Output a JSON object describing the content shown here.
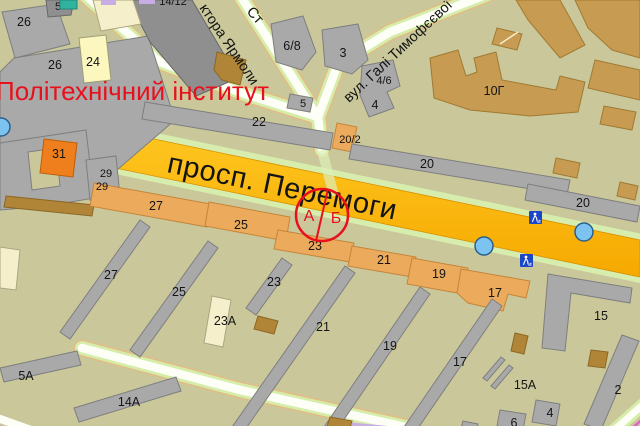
{
  "poi": {
    "institute": "Політехнічний інститут"
  },
  "streets": {
    "avenue": "просп. Перемоги",
    "tymofieievoi": "вул. Галі Тимофєєвої",
    "yarmoly_partial": "ктора Ярмоли",
    "st_partial": "Ст"
  },
  "marker": {
    "a": "А",
    "b": "Б"
  },
  "labels": [
    {
      "t": "26"
    },
    {
      "t": "5"
    },
    {
      "t": "26"
    },
    {
      "t": "24"
    },
    {
      "t": "14/12"
    },
    {
      "t": "6/8"
    },
    {
      "t": "3"
    },
    {
      "t": "4/6"
    },
    {
      "t": "4"
    },
    {
      "t": "5"
    },
    {
      "t": "22"
    },
    {
      "t": "20/2"
    },
    {
      "t": "20"
    },
    {
      "t": "20"
    },
    {
      "t": "10Г"
    },
    {
      "t": "31"
    },
    {
      "t": "29"
    },
    {
      "t": "29"
    },
    {
      "t": "27"
    },
    {
      "t": "25"
    },
    {
      "t": "23"
    },
    {
      "t": "21"
    },
    {
      "t": "19"
    },
    {
      "t": "17"
    },
    {
      "t": "27"
    },
    {
      "t": "25"
    },
    {
      "t": "23"
    },
    {
      "t": "23А"
    },
    {
      "t": "21"
    },
    {
      "t": "19"
    },
    {
      "t": "17"
    },
    {
      "t": "15"
    },
    {
      "t": "15А"
    },
    {
      "t": "2"
    },
    {
      "t": "4"
    },
    {
      "t": "6"
    },
    {
      "t": "5А"
    },
    {
      "t": "14А"
    }
  ],
  "colors": {
    "background": "#CAC89B",
    "avenue_yellow": "#FFC208",
    "minor_road": "#FDFEF5",
    "road_halo_green": "#D5EDA9",
    "poi_red": "#E8101C",
    "stop_blue": "#7CC4EF",
    "crossing_icon_blue": "#1C46C8",
    "building_gray": "#A9A9A9",
    "building_tan": "#C79B51",
    "building_orange": "#EBAA5C"
  },
  "icons": {
    "stop_count": "3",
    "pedestrian_crossing_count": "2"
  }
}
